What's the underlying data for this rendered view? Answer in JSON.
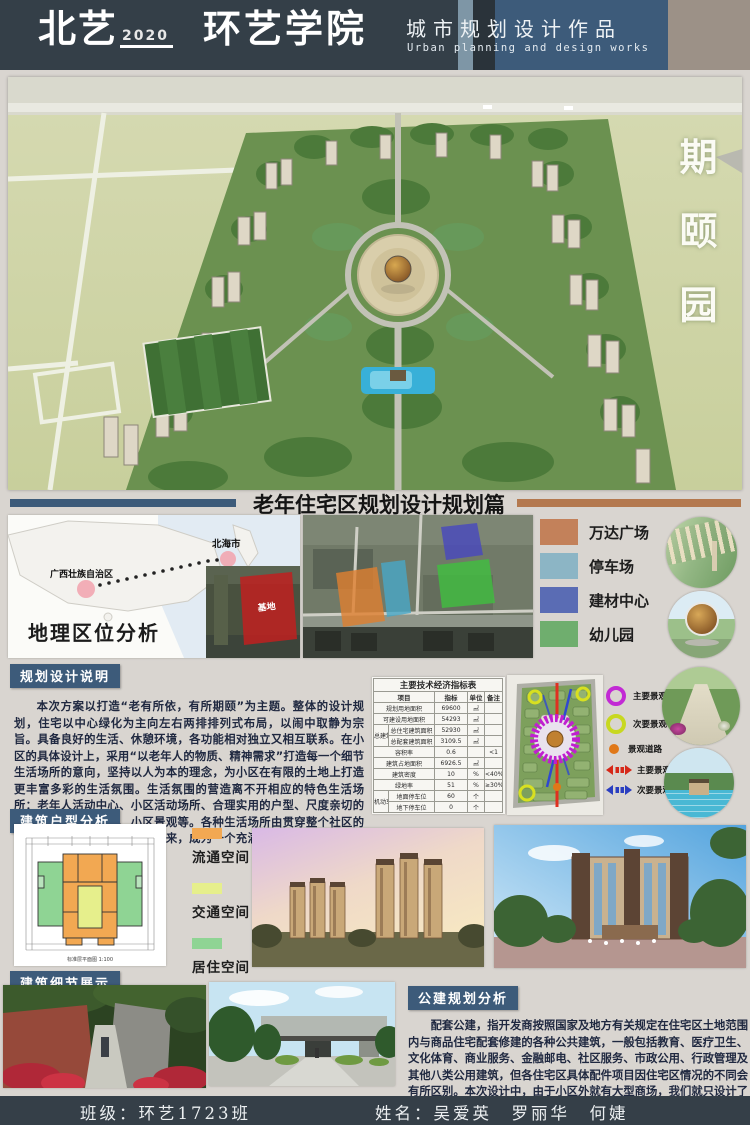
{
  "header": {
    "logo_primary": "北艺",
    "logo_year": "2020",
    "logo_secondary": "环艺学院",
    "work_title_cn": "城市规划设计作品",
    "work_title_en": "Urban planning and design works"
  },
  "hero": {
    "project_name": "期颐园"
  },
  "main_title": "老年住宅区规划设计规划篇",
  "location_map": {
    "title": "地理区位分析",
    "province_label": "广西壮族自治区",
    "city_label": "北海市",
    "site_label": "基地"
  },
  "land_use_legend": {
    "items": [
      {
        "label": "万达广场",
        "color": "#c3815a"
      },
      {
        "label": "停车场",
        "color": "#8cb5c5"
      },
      {
        "label": "建材中心",
        "color": "#5a6cb4"
      },
      {
        "label": "幼儿园",
        "color": "#6fae6e"
      }
    ]
  },
  "planning_notes": {
    "title": "规划设计说明",
    "body": "本次方案以打造“老有所依，有所期颐”为主题。整体的设计规划，住宅以中心绿化为主向左右两排排列式布局，以闹中取静为宗旨。具备良好的生活、休憩环境，各功能相对独立又相互联系。在小区的具体设计上，采用“以老年人的物质、精神需求”打造每一个细节生活场所的意向，坚持以人为本的理念，为小区在有限的土地上打造更丰富多彩的生活氛围。生活氛围的营造离不开相应的特色生活场所：老年人活动中心、小区活动场所、合理实用的户型、尺度亲切的铺装、组团交流空间、小区景观等。各种生活场所由贯穿整个社区的网格状绿地系统有机的联系起来，成为一个充满生活气息老年人住宅小区。"
  },
  "indicators_table": {
    "title": "主要技术经济指标表",
    "headers": [
      "项目",
      "指标",
      "单位",
      "备注"
    ],
    "rows": [
      {
        "item": "规划用地面积",
        "value": "69600",
        "unit": "㎡",
        "note": ""
      },
      {
        "item": "可建设用地面积",
        "value": "54293",
        "unit": "㎡",
        "note": ""
      },
      {
        "group": "总建筑面积",
        "group_span": 2,
        "sub": true,
        "item": "总住宅建筑面积",
        "value": "52930",
        "unit": "㎡",
        "note": ""
      },
      {
        "sub": true,
        "item": "总配套建筑面积",
        "value": "3109.5",
        "unit": "㎡",
        "note": ""
      },
      {
        "item": "容积率",
        "value": "0.6",
        "unit": "",
        "note": "<1"
      },
      {
        "item": "建筑占地面积",
        "value": "6926.5",
        "unit": "㎡",
        "note": ""
      },
      {
        "item": "建筑密度",
        "value": "10",
        "unit": "%",
        "note": "<40%"
      },
      {
        "item": "绿地率",
        "value": "51",
        "unit": "%",
        "note": "≥30%"
      },
      {
        "group": "机动车停车位",
        "group_span": 2,
        "sub": true,
        "item": "地面停车位",
        "value": "60",
        "unit": "个",
        "note": ""
      },
      {
        "sub": true,
        "item": "地下停车位",
        "value": "0",
        "unit": "个",
        "note": ""
      }
    ]
  },
  "masterplan_legend": {
    "items": [
      {
        "type": "ring",
        "color": "#c22ad4",
        "label": "主要景观"
      },
      {
        "type": "ring",
        "color": "#c8d820",
        "label": "次要景观"
      },
      {
        "type": "dot",
        "color": "#e07818",
        "label": "景观道路"
      },
      {
        "type": "axis",
        "color": "#d62818",
        "label": "主要景观轴线"
      },
      {
        "type": "axis",
        "color": "#2a3ec0",
        "label": "次要景观轴线"
      }
    ]
  },
  "unit_analysis": {
    "title": "建筑户型分析",
    "plan_caption": "标准层平面图 1:100",
    "legend": [
      {
        "label": "流通空间",
        "color": "#f2a852"
      },
      {
        "label": "交通空间",
        "color": "#e6ef8c"
      },
      {
        "label": "居住空间",
        "color": "#8fd494"
      }
    ]
  },
  "detail_section": {
    "title": "建筑细节展示"
  },
  "public_building": {
    "title": "公建规划分析",
    "body": "配套公建，指开发商按照国家及地方有关规定在住宅区土地范围内与商品住宅配套修建的各种公共建筑，一般包括教育、医疗卫生、文化体育、商业服务、金融邮电、社区服务、市政公用、行政管理及其他八类公用建筑，但各住宅区具体配件项目因住宅区情况的不同会有所区别。本次设计中，由于小区外就有大型商场，我们就只设计了一些医疗卫生，社区服务的公建配套，设置在小区中心和出入口，给每户居民都带来便捷性。"
  },
  "footer": {
    "class_label": "班级：环艺1723班",
    "name_label": "姓名：吴爱英　罗丽华　何婕"
  },
  "accent_colors": {
    "header_dark": "#343f48",
    "panel_blue": "#3d5b7a",
    "bar_orange": "#b4794f"
  }
}
